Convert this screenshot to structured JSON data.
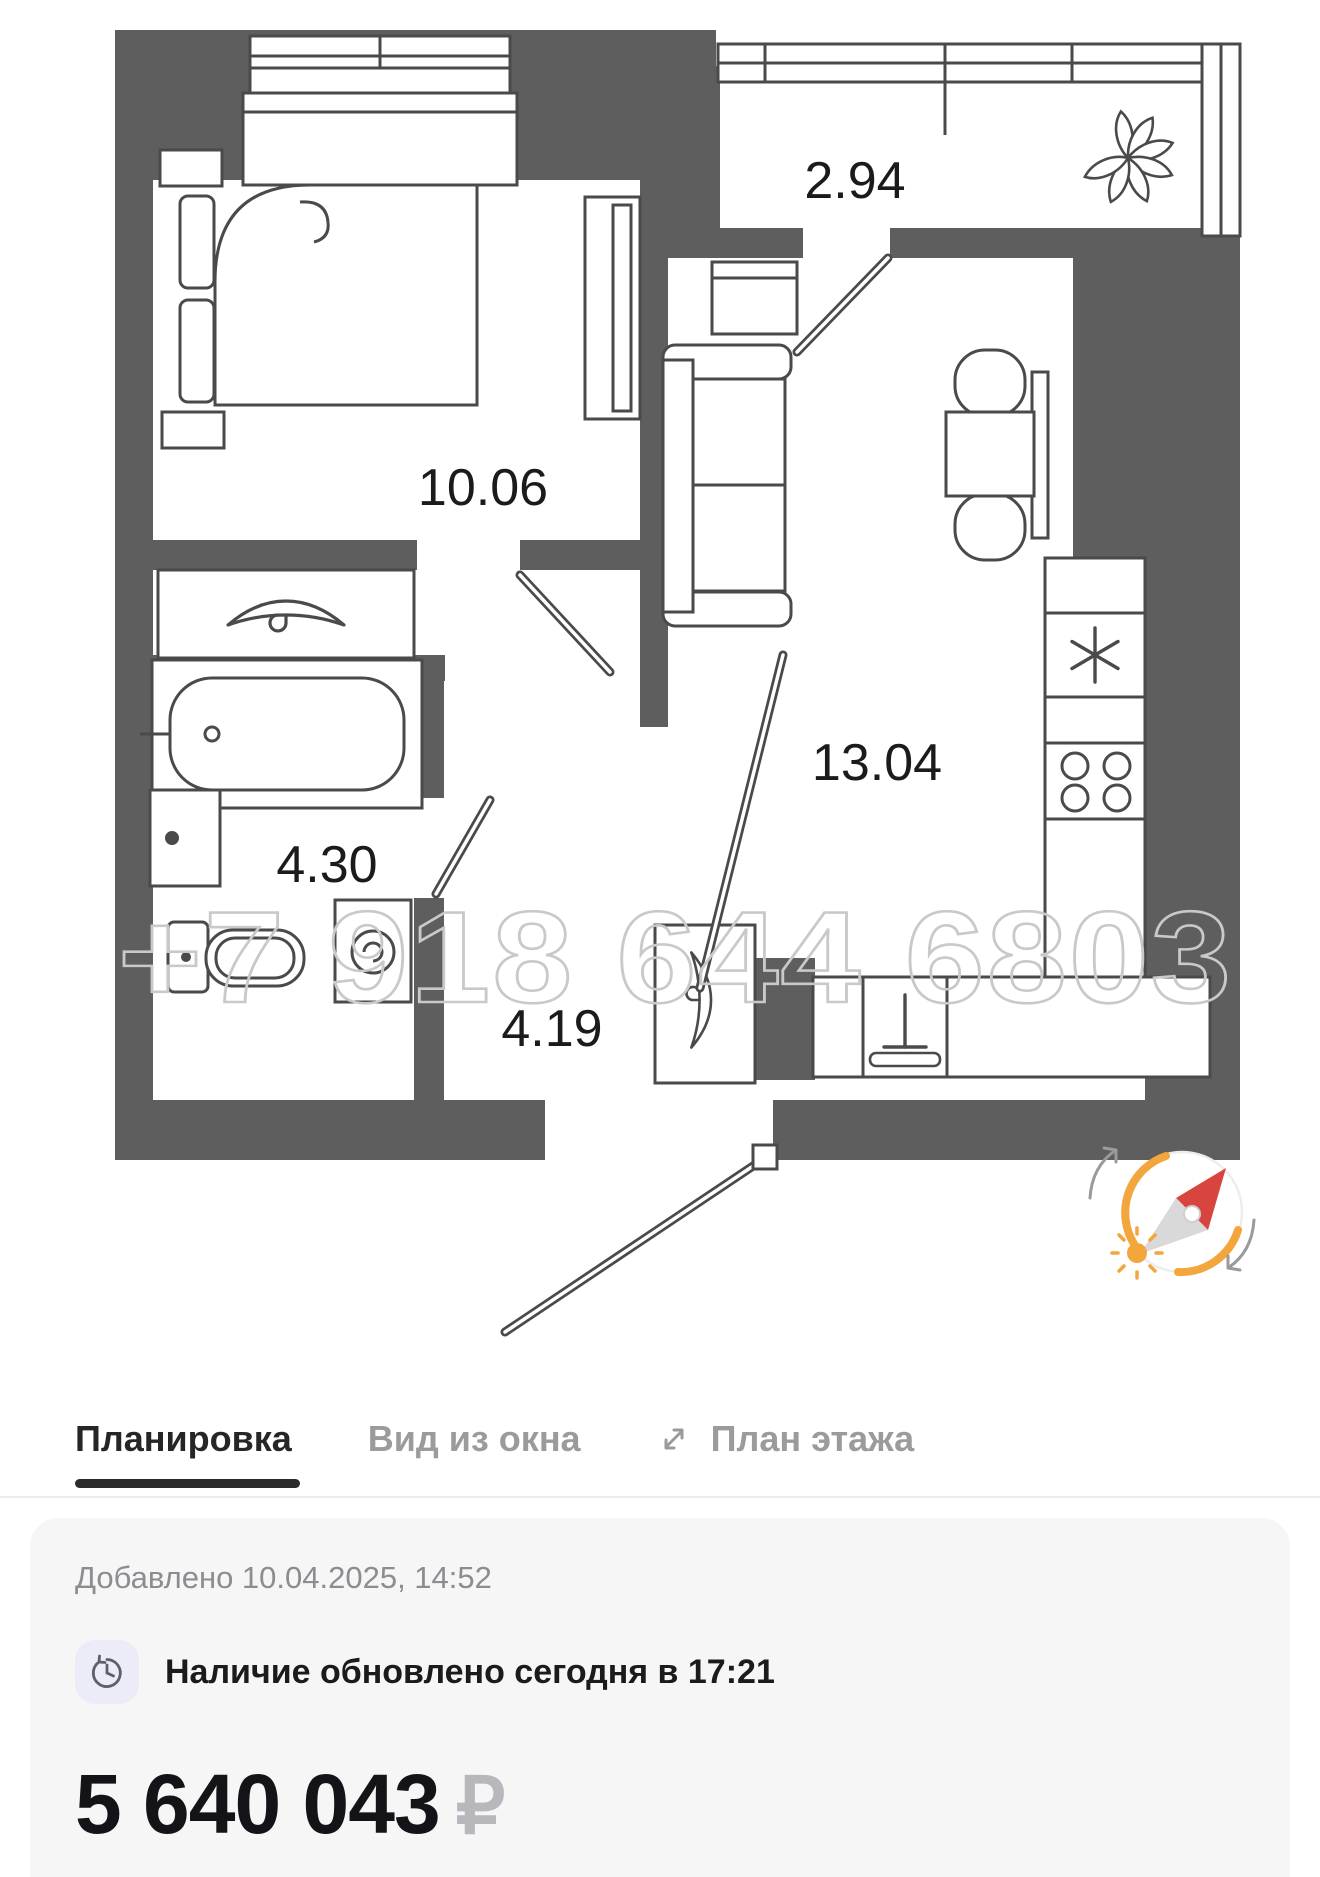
{
  "floor_plan": {
    "watermark": "+7 918 644 6803",
    "rooms": [
      {
        "name": "bedroom",
        "area": "10.06"
      },
      {
        "name": "balcony",
        "area": "2.94"
      },
      {
        "name": "living-kitchen",
        "area": "13.04"
      },
      {
        "name": "bathroom",
        "area": "4.30"
      },
      {
        "name": "hallway",
        "area": "4.19"
      }
    ],
    "colors": {
      "wall": "#5E5E5E",
      "furniture_line": "#4A4A4A",
      "label": "#1B1B1B",
      "watermark": "#C9C9C9"
    },
    "compass": {
      "accent": "#F2A63C",
      "needle_north": "#D8453E",
      "needle_south": "#D9D9D9"
    }
  },
  "tabs": {
    "items": [
      {
        "label": "Планировка",
        "active": true
      },
      {
        "label": "Вид из окна",
        "active": false
      },
      {
        "label": "План этажа",
        "active": false
      }
    ]
  },
  "card": {
    "added": "Добавлено 10.04.2025, 14:52",
    "availability": "Наличие обновлено сегодня в 17:21",
    "price": "5 640 043",
    "currency": "₽",
    "price_note": "Цена при 100% оплате"
  }
}
